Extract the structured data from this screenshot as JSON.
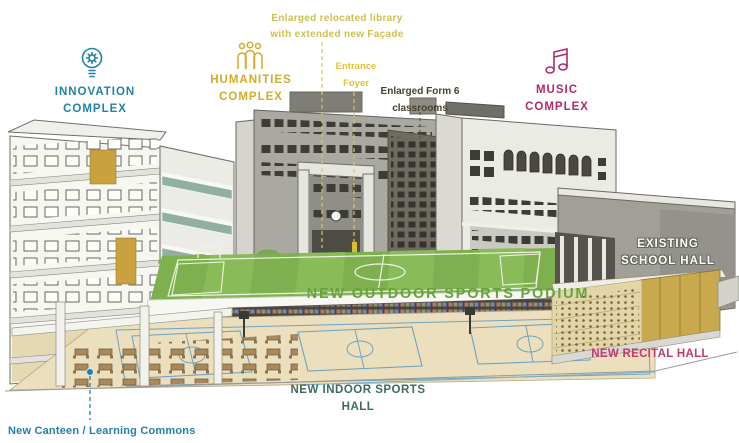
{
  "scene": {
    "description": "Cutaway architectural rendering of school campus redevelopment with annotated facilities"
  },
  "colors": {
    "teal": "#2380a8",
    "gold": "#d2ac29",
    "olive_note": "#cdbf4e",
    "yellow_foyer": "#dfc23b",
    "magenta": "#b12a6c",
    "recital_magenta": "#c13a6e",
    "green_podium": "#69a33e",
    "indoor_teal": "#3e6b5b",
    "dark_text": "#45412f",
    "white_label": "#ffffff",
    "field_green": "#7fb04f",
    "floor_tan": "#ecdfbd"
  },
  "annotations": {
    "library_note": {
      "line1": "Enlarged relocated library",
      "line2": "with extended new Façade"
    },
    "innovation": {
      "line1": "INNOVATION",
      "line2": "COMPLEX",
      "icon": "lightbulb-gear-icon"
    },
    "humanities": {
      "line1": "HUMANITIES",
      "line2": "COMPLEX",
      "icon": "people-group-icon"
    },
    "entrance_foyer": {
      "line1": "Entrance",
      "line2": "Foyer"
    },
    "form6": {
      "line1": "Enlarged Form 6",
      "line2": "classrooms"
    },
    "music": {
      "line1": "MUSIC",
      "line2": "COMPLEX",
      "icon": "music-notes-icon"
    },
    "existing_hall": {
      "line1": "EXISTING",
      "line2": "SCHOOL HALL"
    },
    "outdoor_podium": {
      "label": "NEW OUTDOOR SPORTS PODIUM"
    },
    "indoor_hall": {
      "label": "NEW INDOOR SPORTS HALL"
    },
    "recital_hall": {
      "label": "NEW RECITAL HALL"
    },
    "canteen": {
      "label": "New Canteen / Learning Commons",
      "marker": "location-dot-icon"
    }
  }
}
